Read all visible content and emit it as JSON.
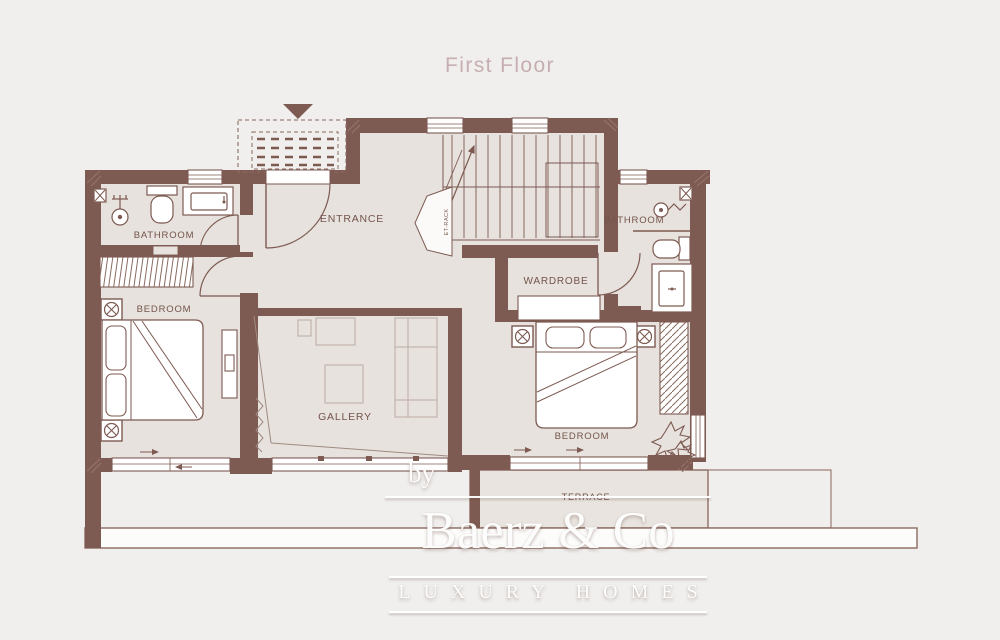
{
  "title": "First Floor",
  "rooms": {
    "bathroom_left": {
      "label": "BATHROOM"
    },
    "bedroom_left": {
      "label": "BEDROOM"
    },
    "entrance": {
      "label": "ENTRANCE"
    },
    "gallery": {
      "label": "GALLERY"
    },
    "wardrobe": {
      "label": "WARDROBE"
    },
    "bathroom_right": {
      "label": "BATHROOM"
    },
    "bedroom_right": {
      "label": "BEDROOM"
    },
    "terrace": {
      "label": "TERRACE"
    }
  },
  "annotations": {
    "stair_closet": "ET-RACK"
  },
  "watermark": {
    "prefix": "by",
    "brand": "Baerz & Co",
    "tagline": "LUXURY HOMES"
  },
  "icons": {
    "entrance_marker": "triangle-down",
    "ceiling_spot": "circle-cross-in-box",
    "wall_point": "cross-in-box"
  },
  "colors": {
    "background": "#f0efed",
    "wall": "#7e5b52",
    "floor": "#e7e2dd",
    "terrace_floor": "#e9e4df",
    "line": "#7d5a52",
    "faint_line": "#bcaaa2",
    "title": "#c6aeb1",
    "watermark": "#ffffff"
  }
}
